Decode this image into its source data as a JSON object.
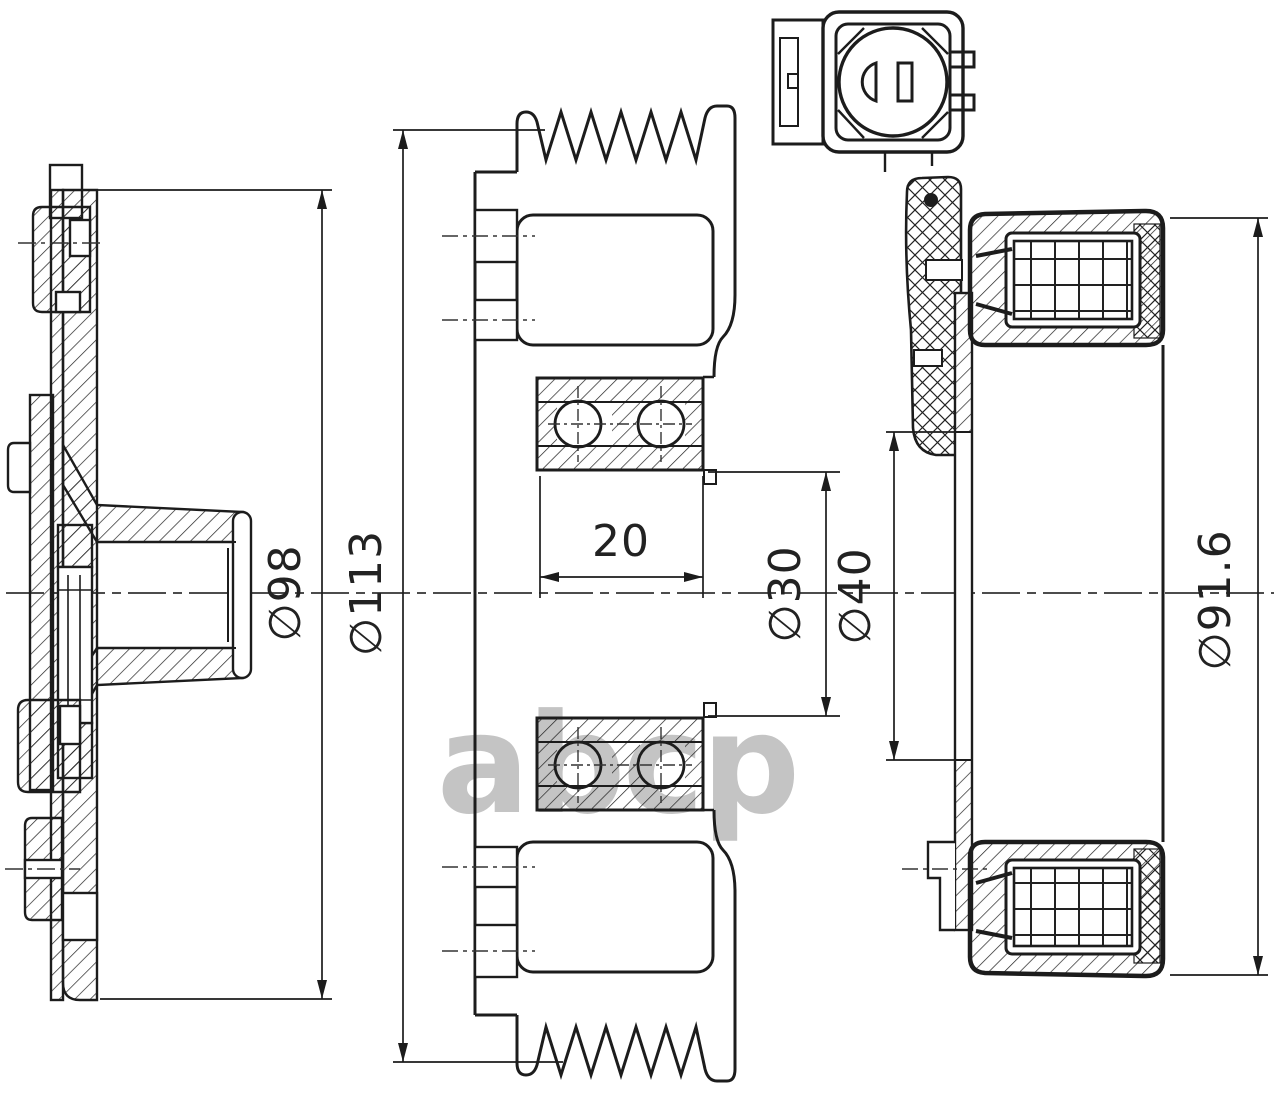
{
  "drawing": {
    "type": "technical-section-drawing",
    "subject": "AC compressor clutch pulley assembly: clutch disc, grooved pulley with ball bearing, electromagnetic coil housing and connector",
    "colors": {
      "line": "#1c1c1c",
      "background": "#ffffff",
      "watermark": "#c4c4c4"
    },
    "watermark": {
      "text": "abcp"
    },
    "dimensions": {
      "disc_diameter": {
        "label": "∅98"
      },
      "pulley_diameter": {
        "label": "∅113"
      },
      "bearing_width": {
        "label": "20"
      },
      "bearing_bore": {
        "label": "∅30"
      },
      "coil_bore": {
        "label": "∅40"
      },
      "coil_diameter": {
        "label": "∅91.6"
      }
    }
  }
}
